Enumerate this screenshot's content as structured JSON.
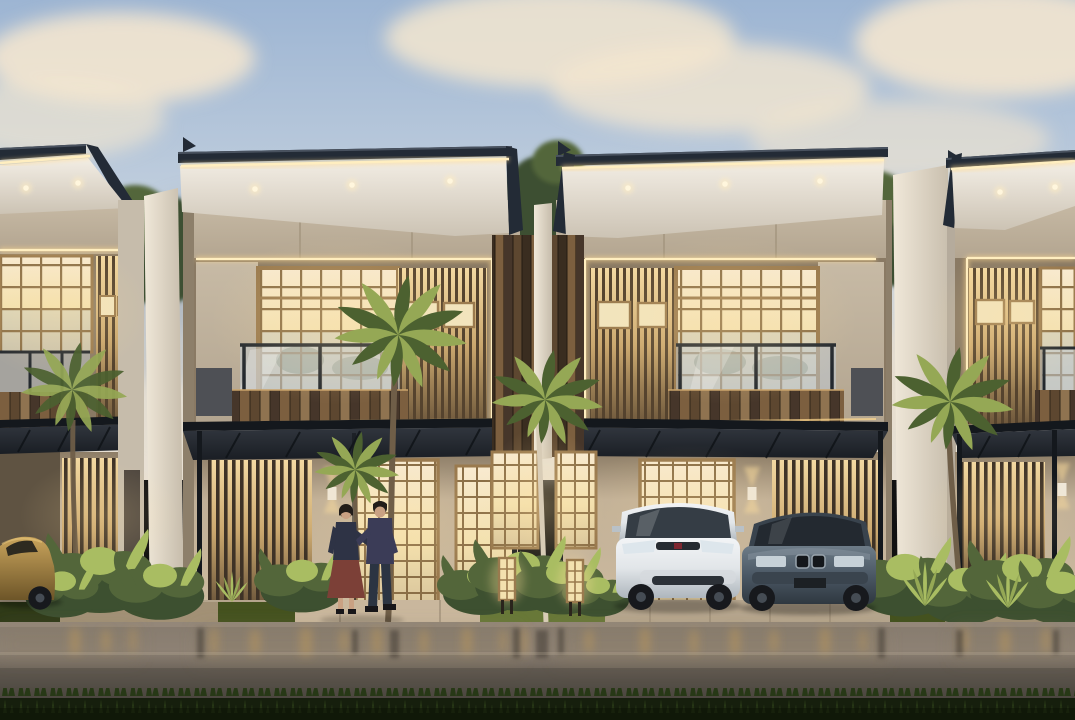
{
  "scene": {
    "type": "architectural-rendering",
    "time_of_day": "dusk",
    "setting": "row of modern two-storey tropical townhouses with warm interior lighting, wet street in foreground",
    "units_visible": 4,
    "architecture": [
      "flat cantilevered roofs with dark fascia and warm LED strip lighting",
      "recessed soffit downlights",
      "taupe upper walls",
      "backlit shoji-style gridded windows",
      "vertical timber slat screens",
      "timber plank balcony parapets with glass balustrades",
      "black steel carport canopies on slim posts",
      "white separating fin walls",
      "timber plank party wall at center with white pillar"
    ],
    "vehicles": [
      {
        "label": "bronze sedan",
        "position": "far left under carport"
      },
      {
        "label": "white hatchback",
        "position": "center-right carport"
      },
      {
        "label": "dark slate sedan",
        "position": "right of white hatchback"
      }
    ],
    "people": [
      {
        "label": "woman walking",
        "details": "dark jacket, maroon skirt"
      },
      {
        "label": "man walking",
        "details": "dark sweater, jeans"
      }
    ],
    "vegetation": [
      "palm trees in front of facades",
      "tropical shrubs along bases",
      "background trees between roofs",
      "dark lawn strip in foreground"
    ],
    "lighting": [
      "warm LED strips on roof fascias and facade frames",
      "up-down wall sconces",
      "shoji floor lanterns in center garden",
      "soffit downlights"
    ],
    "weather": "recently wet pavement with warm light reflections, soft pink-cream clouds"
  },
  "palette": {
    "skyTop": "#9db5d3",
    "skyMid": "#c3d0de",
    "skyLow": "#e3ddd2",
    "cloudCream": "#f3e6cf",
    "cloudGray": "#a8b1bb",
    "treeDark": "#3d5030",
    "treeMid": "#53663a",
    "bushLit": "#a9bd62",
    "roofDark": "#232b36",
    "roofEdge": "#49525f",
    "led": "#ffeec0",
    "ledGlow": "#ffd98e",
    "soffitLight": "#f3eee5",
    "soffitDark": "#ccc3b4",
    "taupe": "#b2a48f",
    "taupeLight": "#c7baa5",
    "wallShade": "#8d7f6a",
    "beige": "#c0af97",
    "whiteFin": "#f0e8d9",
    "finShade": "#c6bcab",
    "grayPanel": "#4e5055",
    "shojiGlow": "#f3e1af",
    "shojiFrame": "#9a7a4e",
    "shojiGrid": "#8a6e46",
    "slatBar": "#55432e",
    "slatGroundBar": "#3e3226",
    "plank1": "#7c5f3f",
    "plank2": "#5d4730",
    "plank3": "#8f7350",
    "plank4": "#46362a",
    "glassTint": "#bfccd8",
    "railDark": "#23282e",
    "canopyDark": "#14181d",
    "pave": "#b5a58d",
    "paveLight": "#c9b79d",
    "paveDark": "#a29176",
    "grassStrip": "#44521f",
    "grassLit": "#687838",
    "grassDark": "#2f3a18",
    "roadLight": "#8d8174",
    "road": "#6e655b",
    "roadDark": "#4e4840",
    "reflGold": "#c49c58",
    "reflDark": "#474138",
    "fgGrass": "#161f0d",
    "fgBlade": "#273816",
    "palmLit": "#95a855",
    "palmDark": "#4c6130",
    "trunk": "#6f5e48",
    "trunkLit": "#d8ccb6",
    "hondaBody": "#e2e6e9",
    "carGlass": "#353d45",
    "bmwBody": "#4b5865",
    "bmwLight": "#6e7c88",
    "goldLit": "#c9a45c",
    "goldBody": "#9a7a3c",
    "wheelDark": "#17191d",
    "hub": "#454c54",
    "skin": "#c9a183",
    "hair": "#221d19",
    "jacket": "#2e3345",
    "skirt": "#7c4037",
    "sweater": "#3b3c57",
    "jeans": "#2b3442",
    "shoe": "#17161a",
    "glowWarm": "#ffdf9e",
    "sconceBox": "#efe7d8"
  }
}
